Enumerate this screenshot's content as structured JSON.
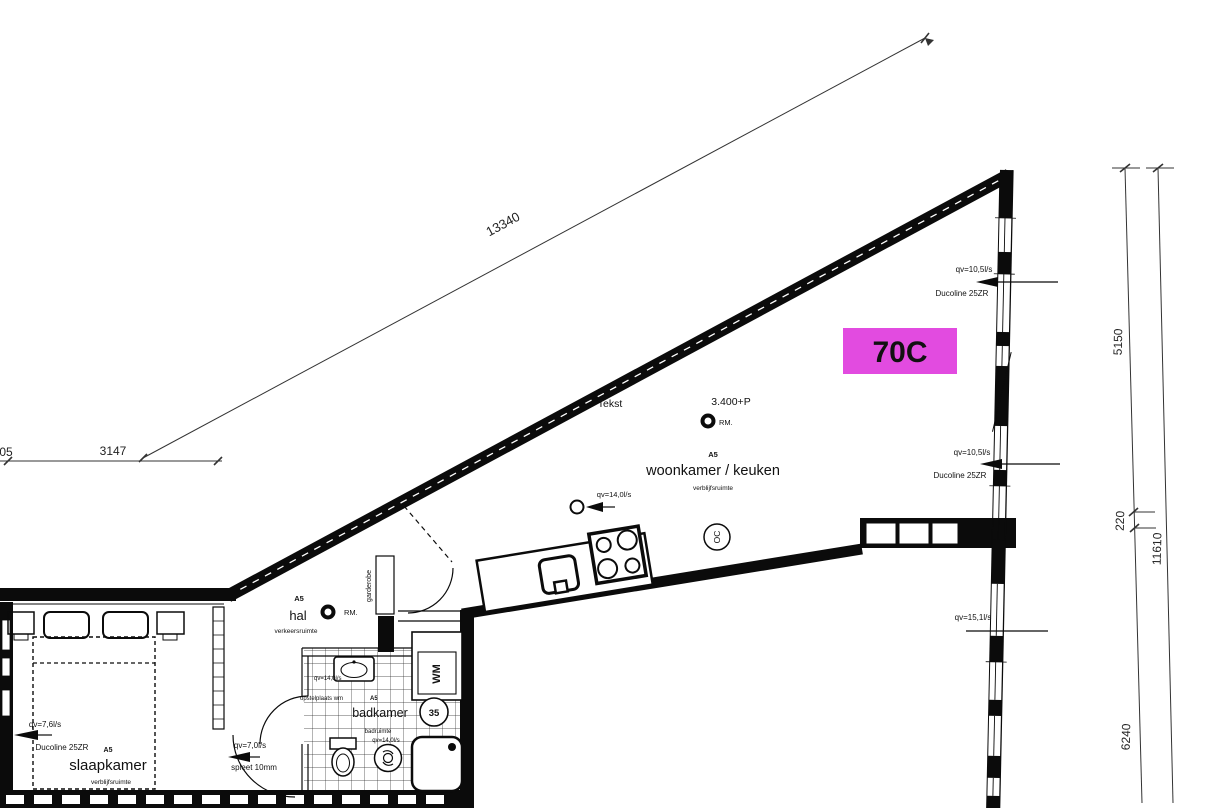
{
  "drawing": {
    "unit_label": "70C",
    "highlight_color": "#e24be0",
    "tekst_note": "Tekst"
  },
  "dimensions": {
    "diagonal_top": "13340",
    "left_edge_partial": "05",
    "left_horizontal": "3147",
    "right_upper": "5150",
    "right_spacer": "220",
    "right_overall": "11610",
    "right_lower": "6240"
  },
  "rooms": {
    "woonkamer": {
      "tag": "A5",
      "name": "woonkamer / keuken",
      "category": "verblijfsruimte",
      "level": "3.400+P",
      "meter": "RM.",
      "symbol": "OC"
    },
    "hal": {
      "tag": "A5",
      "name": "hal",
      "category": "verkeersruimte",
      "meter": "RM."
    },
    "slaapkamer": {
      "name": "slaapkamer",
      "category": "verblijfsruimte"
    },
    "badkamer": {
      "name": "badkamer",
      "number": "35",
      "category": "badruimte",
      "qv_top": "qv=14,0l/s",
      "note": "opstelplaats wm",
      "note_tag": "A5",
      "qv_bottom": "qv=14,0l/s"
    },
    "closets": {
      "wm": "WM",
      "garderobe": "garderobe"
    }
  },
  "ventilation": {
    "facade_top": {
      "qv": "qv=10,5l/s",
      "device": "Ducoline 25ZR"
    },
    "facade_mid": {
      "qv": "qv=10,5l/s",
      "device": "Ducoline 25ZR"
    },
    "facade_low": {
      "qv": "qv=15,1l/s"
    },
    "kitchen": {
      "qv": "qv=14,0l/s"
    },
    "bedroom": {
      "qv": "qv=7,6l/s",
      "device": "Ducoline 25ZR",
      "tag": "A5"
    },
    "bedroom_door": {
      "qv": "qv=7,0l/s",
      "note": "spleet 10mm"
    }
  }
}
